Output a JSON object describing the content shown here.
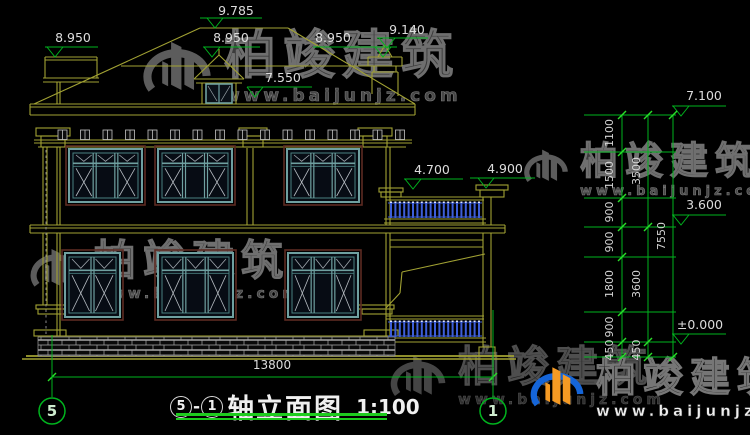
{
  "page": {
    "background": "#000000"
  },
  "watermark": {
    "brand": "柏竣建筑",
    "site": "www.baijunjz.com"
  },
  "title": {
    "axis_from": "5",
    "separator": "-",
    "axis_to": "1",
    "name": "轴立面图",
    "scale": "1:100"
  },
  "axis_bubbles": {
    "left": "5",
    "right": "1"
  },
  "elevations": {
    "ridge": "9.785",
    "eave_left": "8.950",
    "eave_mid": "8.950",
    "eave_right": "8.950",
    "chimney_top": "9.140",
    "main_eave": "7.550",
    "balcony_rail": "4.700",
    "porch_column": "4.900",
    "right_top": "7.100",
    "second_floor": "3.600",
    "ground": "±0.000"
  },
  "dimensions": {
    "total_width": "13800",
    "right_chain": {
      "col1": [
        "1100",
        "1500",
        "900",
        "900",
        "1800",
        "900",
        "450"
      ],
      "col2": [
        "3500",
        "3600",
        "450"
      ],
      "col3": [
        "7550"
      ]
    }
  },
  "colors": {
    "line": "#a2a233",
    "annotation": "#00b41e",
    "tick": "#2ade2a",
    "window_frame": "#6fa0a0",
    "window_trim": "#5d2a22",
    "baluster": "#3d5ed8",
    "logo_blue": "#1565d8",
    "logo_orange": "#f59a23",
    "underline": "#1ecb1e"
  }
}
